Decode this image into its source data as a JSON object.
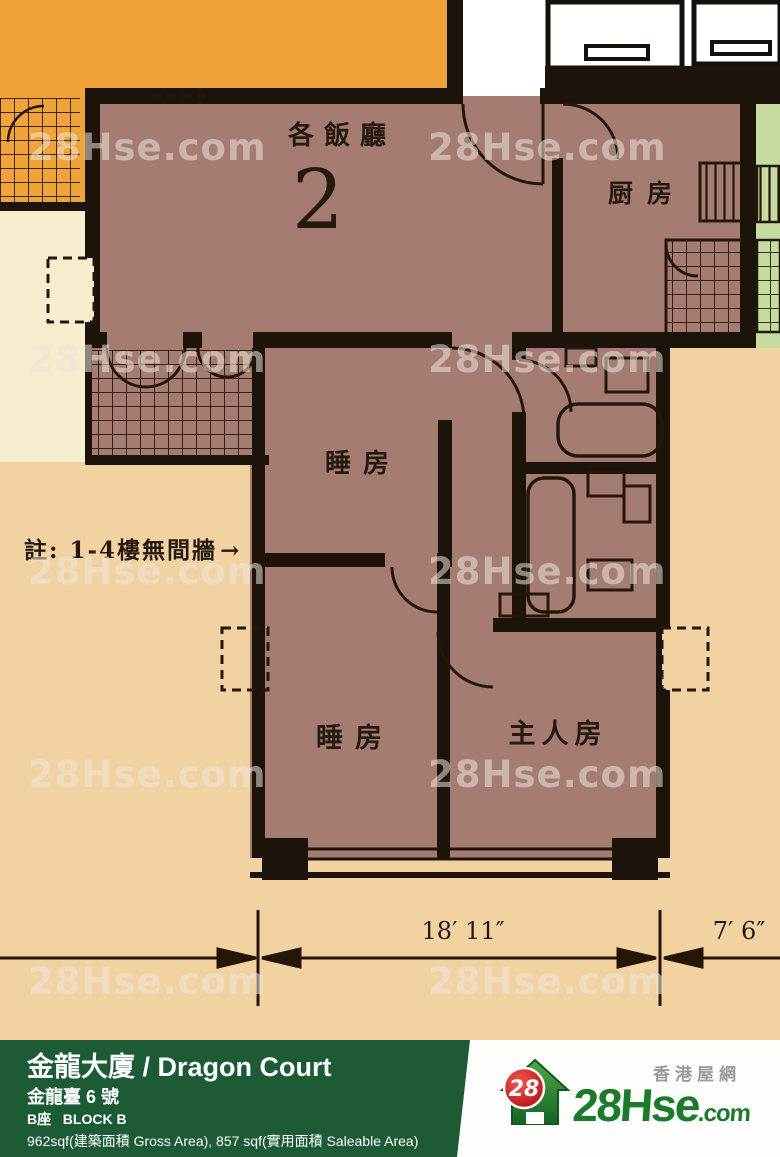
{
  "watermark": {
    "text": "28Hse.com"
  },
  "plan": {
    "living_dining_label": "各飯廳",
    "unit_number": "2",
    "kitchen_label": "厨房",
    "bedroom1_label": "睡房",
    "bedroom2_label": "睡房",
    "master_bedroom_label": "主人房",
    "note_text": "註: 1-4樓無間牆",
    "note_arrow": "→",
    "dim_main": "18′ 11″",
    "dim_right": "7′ 6″"
  },
  "footer": {
    "title": "金龍大廈 / Dragon Court",
    "address": "金龍臺 6 號",
    "block": "B座   BLOCK B",
    "areas": "962sqf(建築面積 Gross Area), 857 sqf(實用面積 Saleable Area)"
  },
  "logo": {
    "badge": "28",
    "brand_main": "28Hse",
    "brand_suffix": ".com",
    "tagline": "香港屋網"
  },
  "colors": {
    "background": "#f3d2a2",
    "unit_floor": "#a67c72",
    "orange_block": "#efa338",
    "cream_block": "#f6ecce",
    "neighbor_green": "#c5db9f",
    "wall_black": "#1c130b",
    "footer_green": "#1d5b37",
    "logo_red": "#cf1e24",
    "logo_green": "#1c7a2b"
  }
}
